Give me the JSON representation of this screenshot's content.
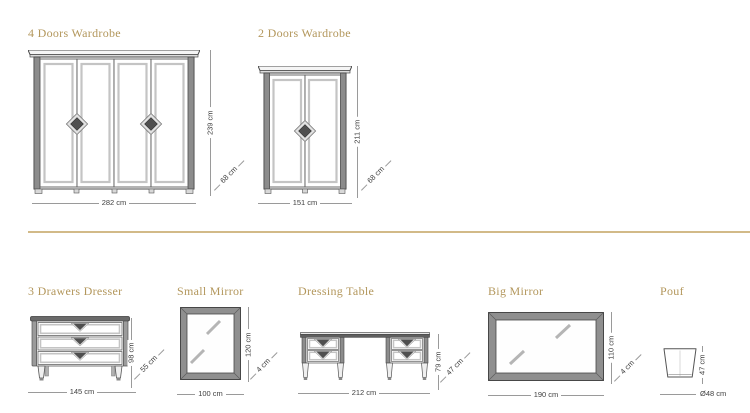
{
  "products": [
    {
      "title": "4 Doors Wardrobe",
      "width": "282 cm",
      "height": "239 cm",
      "depth": "68 cm"
    },
    {
      "title": "2 Doors Wardrobe",
      "width": "151 cm",
      "height": "211 cm",
      "depth": "68 cm"
    },
    {
      "title": "3 Drawers Dresser",
      "width": "145 cm",
      "height": "98 cm",
      "depth": "55 cm"
    },
    {
      "title": "Small Mirror",
      "width": "100 cm",
      "height": "120 cm",
      "depth": "4 cm"
    },
    {
      "title": "Dressing Table",
      "width": "212 cm",
      "height": "79 cm",
      "depth": "47 cm"
    },
    {
      "title": "Big Mirror",
      "width": "190 cm",
      "height": "110 cm",
      "depth": "4 cm"
    },
    {
      "title": "Pouf",
      "width": "Ø48 cm",
      "height": "47 cm"
    }
  ],
  "colors": {
    "title": "#b3975c",
    "divider": "#d2ba88",
    "dimension_line": "#9a9a9a",
    "dimension_text": "#3f3f3f"
  }
}
